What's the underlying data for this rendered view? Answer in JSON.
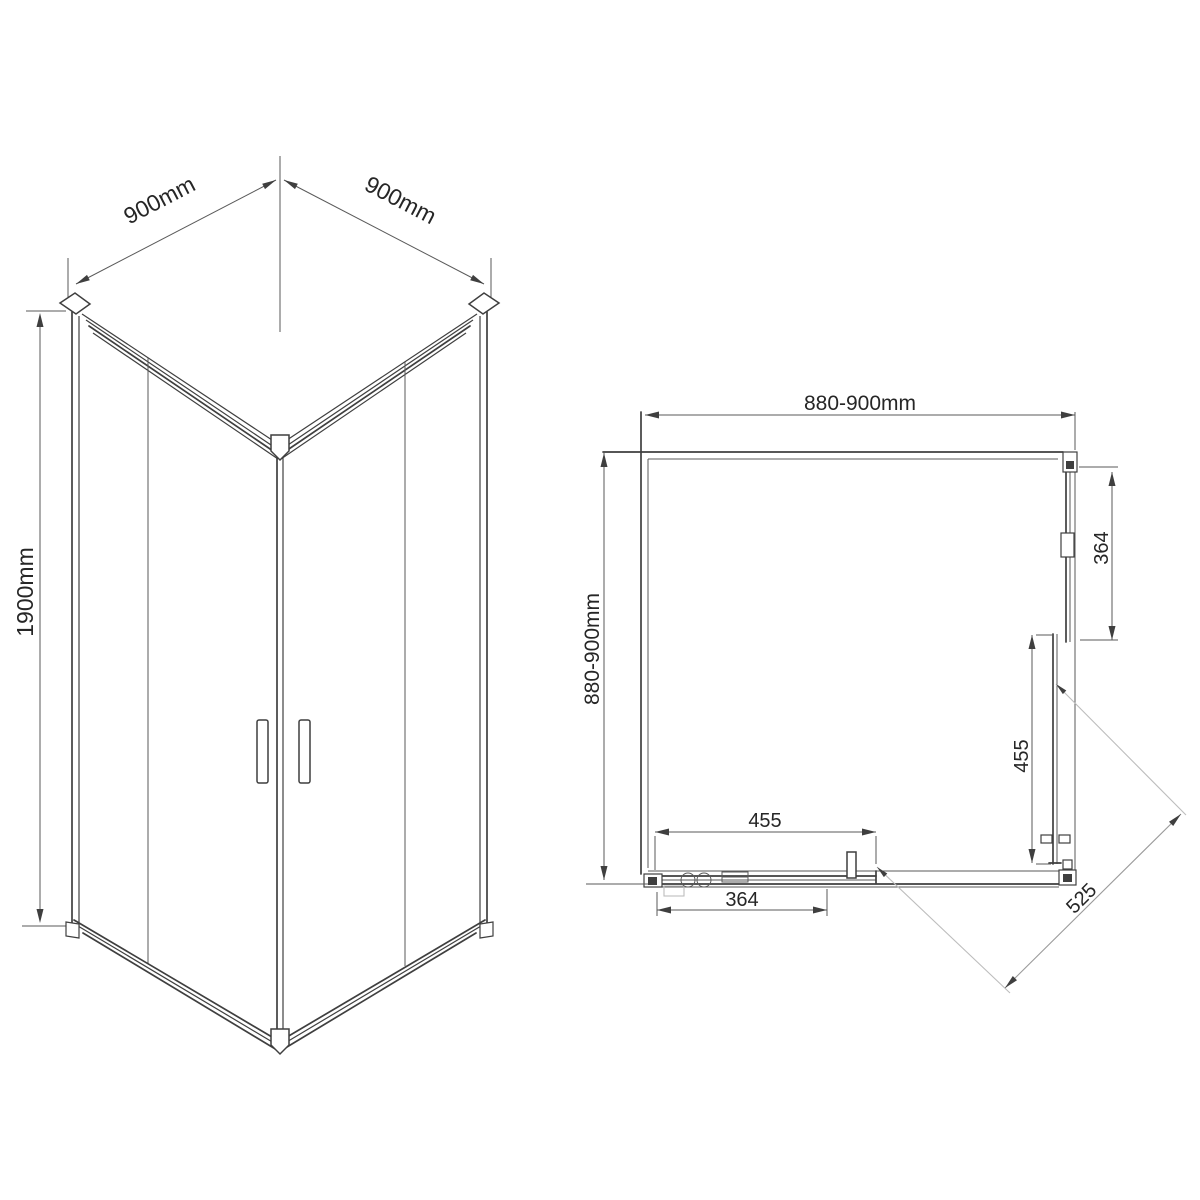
{
  "drawing": {
    "type": "shower-enclosure-technical-drawing",
    "views": [
      "isometric",
      "plan"
    ],
    "colors": {
      "background": "#ffffff",
      "line": "#3f3f3f",
      "faint_line": "#bdbdbd",
      "text": "#262626"
    }
  },
  "labels": {
    "iso_width_left": "900mm",
    "iso_width_right": "900mm",
    "iso_height": "1900mm",
    "plan_width": "880-900mm",
    "plan_depth": "880-900mm",
    "plan_right_panel": "364",
    "plan_right_door": "455",
    "plan_bottom_door": "455",
    "plan_bottom_panel": "364",
    "plan_opening": "525"
  }
}
